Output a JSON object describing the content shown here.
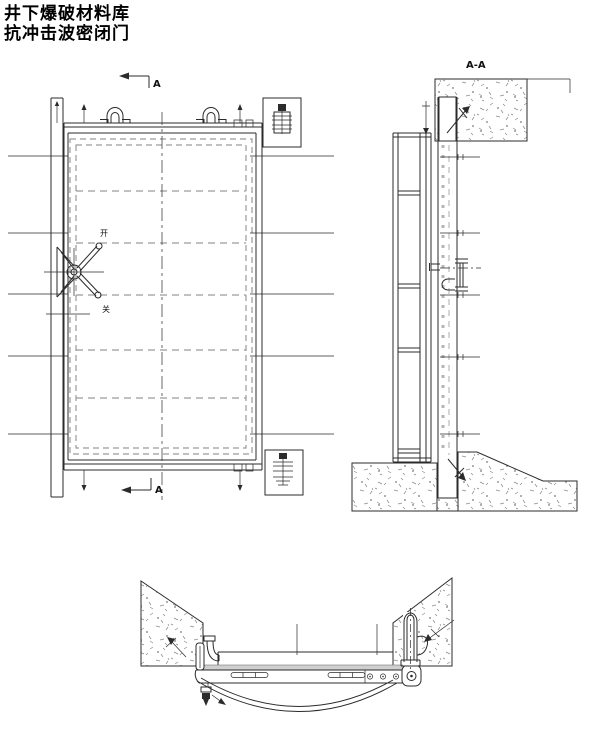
{
  "title": {
    "line1": "井下爆破材料库",
    "line2": "抗冲击波密闭门"
  },
  "front_view": {
    "section_marker_top": "A",
    "section_marker_bottom": "A",
    "handwheel": {
      "open_label": "开",
      "close_label": "关"
    }
  },
  "section_view": {
    "label": "A-A"
  },
  "colors": {
    "line": "#2b2b2b",
    "dashed_gray": "#9a9a9a",
    "seal_band": "#cfcfcf",
    "concrete_speckle": "#8f8f8f",
    "background": "#ffffff",
    "text": "#000000"
  }
}
